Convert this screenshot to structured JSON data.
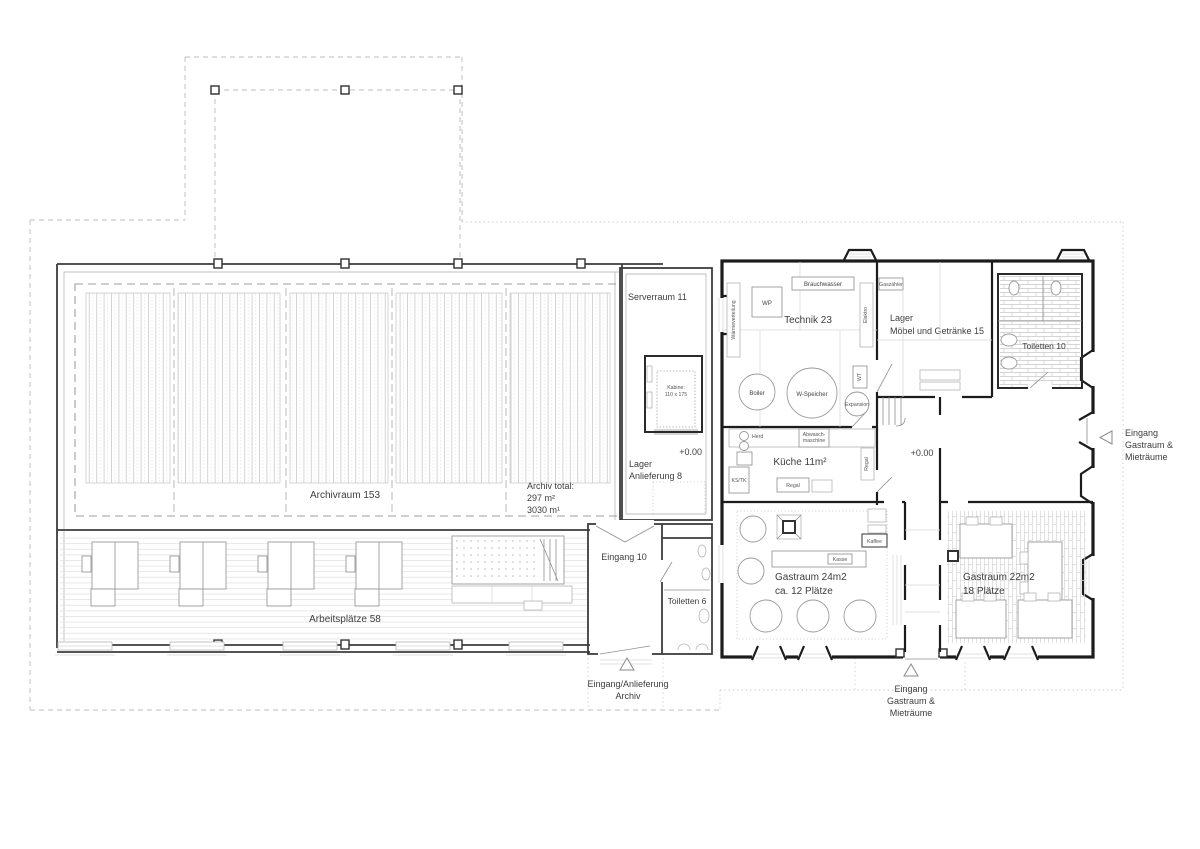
{
  "colors": {
    "background": "#ffffff",
    "wall_dark": "#1c1c1c",
    "wall_medium": "#3c3c3c",
    "line_light": "#9a9a9a",
    "dashed_outline": "#bcbcbc",
    "text": "#3d3d3d"
  },
  "rooms": {
    "archivraum": {
      "label": "Archivraum 153"
    },
    "archiv_total": {
      "lines": [
        "Archiv total:",
        "297 m²",
        "3030 m¹"
      ]
    },
    "arbeitsplaetze": {
      "label": "Arbeitsplätze 58"
    },
    "serverraum": {
      "label": "Serverraum 11"
    },
    "lager_anlieferung": {
      "lines": [
        "Lager",
        "Anlieferung 8"
      ],
      "level": "+0.00"
    },
    "eingang10": {
      "label": "Eingang 10"
    },
    "toiletten6": {
      "label": "Toiletten 6"
    },
    "technik": {
      "label": "Technik 23"
    },
    "lager_moebel": {
      "lines": [
        "Lager",
        "Möbel und Getränke 15"
      ]
    },
    "toiletten10": {
      "label": "Toiletten 10"
    },
    "kueche": {
      "label": "Küche 11m²"
    },
    "corridor": {
      "level": "+0.00"
    },
    "gastraum24": {
      "lines": [
        "Gastraum 24m2",
        "ca. 12  Plätze"
      ]
    },
    "gastraum22": {
      "lines": [
        "Gastraum 22m2",
        "18  Plätze"
      ]
    }
  },
  "equipment": {
    "kabine": {
      "lines": [
        "Kabine:",
        "110 x 175"
      ]
    },
    "wp": "WP",
    "brauchwasser": "Brauchwasser",
    "elektro": "Elektro",
    "waermeverteilung": "Wärmeverteilung",
    "boiler": "Boiler",
    "w_speicher": "W-Speicher",
    "wt": "WT",
    "expansion": "Expansion",
    "gaszaehler": "Gaszähler",
    "herd": "Herd",
    "abwaschmaschine": {
      "lines": [
        "Abwasch-",
        "maschine"
      ]
    },
    "regal_wall": "Regal",
    "regal_floor": "Regal",
    "ks_tk": "KS/TK",
    "kasse": "Kasse",
    "kaffee": "Kaffee"
  },
  "entrances": {
    "archiv": {
      "lines": [
        "Eingang/Anlieferung",
        "Archiv"
      ]
    },
    "bottom": {
      "lines": [
        "Eingang",
        "Gastraum &",
        "Mieträume"
      ]
    },
    "right": {
      "lines": [
        "Eingang",
        "Gastraum &",
        "Mieträume"
      ]
    }
  }
}
